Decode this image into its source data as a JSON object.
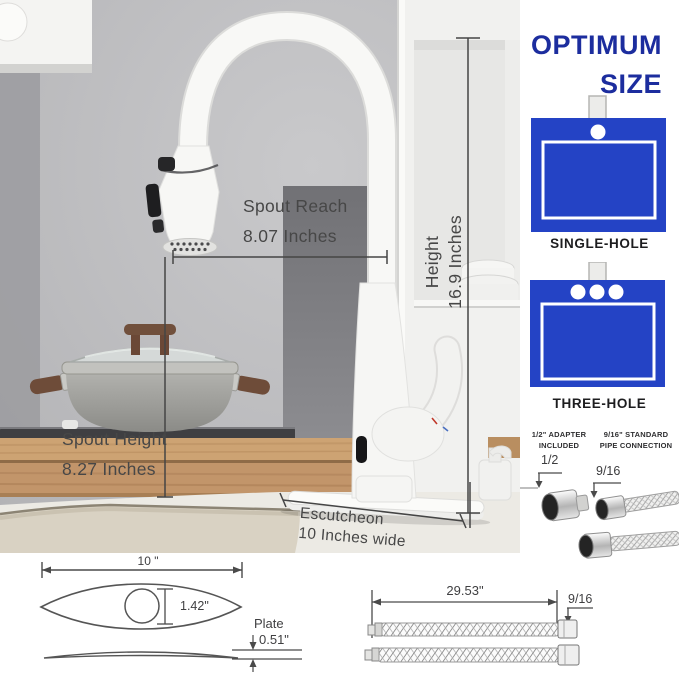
{
  "annotations": {
    "spout_reach_1": "Spout Reach",
    "spout_reach_2": "8.07 Inches",
    "height_1": "Height",
    "height_2": "16.9 Inches",
    "spout_height_1": "Spout Height",
    "spout_height_2": "8.27 Inches",
    "escutcheon_1": "Escutcheon",
    "escutcheon_2": "10 Inches wide"
  },
  "panel": {
    "title_1": "OPTIMUM",
    "title_2": "SIZE",
    "single_hole": "SINGLE-HOLE",
    "three_hole": "THREE-HOLE",
    "adapter_1": "1/2\" ADAPTER",
    "adapter_2": "INCLUDED",
    "pipe_1": "9/16\"  STANDARD",
    "pipe_2": "PIPE CONNECTION",
    "half": "1/2",
    "nine_sixteen": "9/16"
  },
  "plate_diagram": {
    "width": "10 \"",
    "hole": "1.42\"",
    "plate": "Plate",
    "thickness": "0.51\""
  },
  "hose_diagram": {
    "length": "29.53\"",
    "size": "9/16"
  },
  "colors": {
    "blue": "#2443c5",
    "navy": "#1c2d9e",
    "wood": "#c79a6c",
    "wall": "#c2c2c4"
  }
}
